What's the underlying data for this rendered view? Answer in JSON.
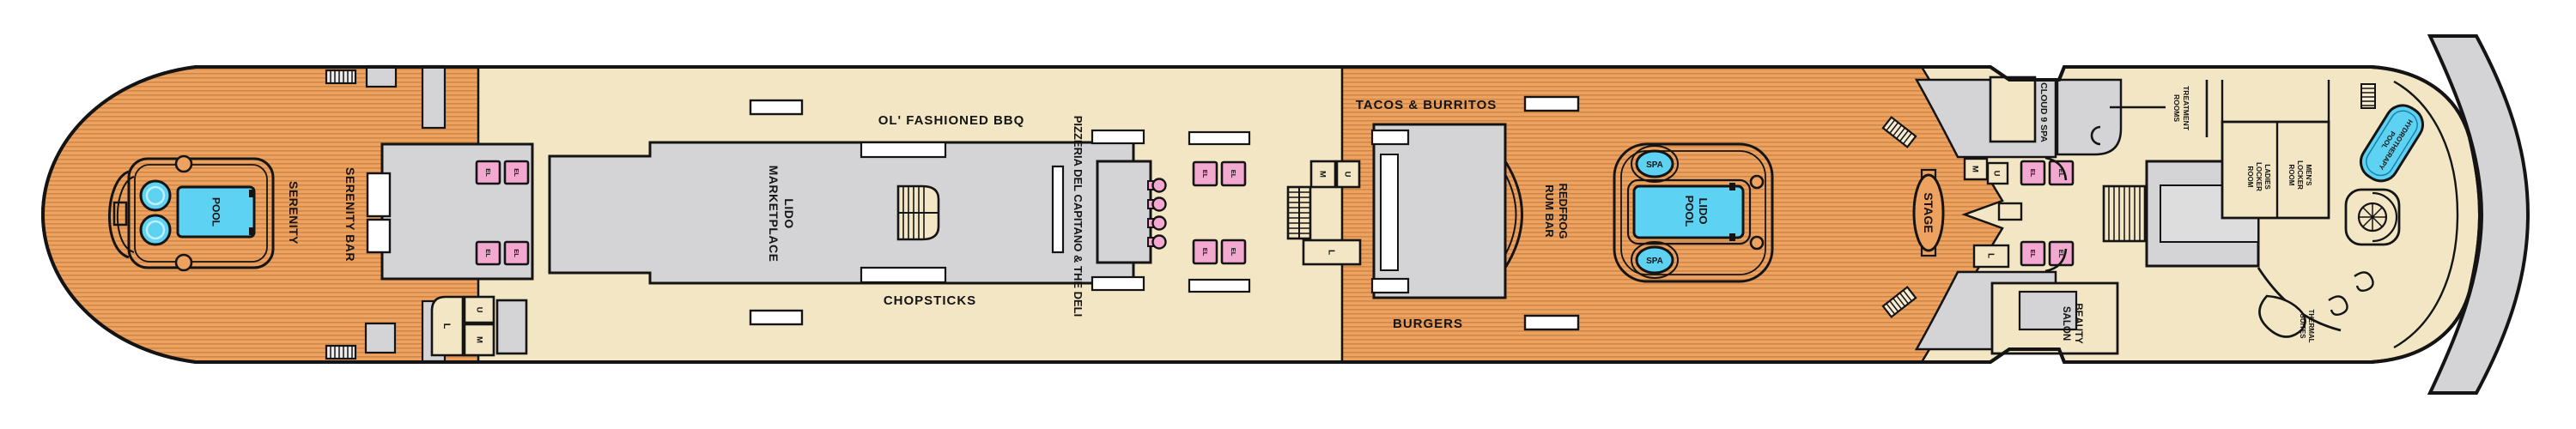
{
  "labels": {
    "serenity": "SERENITY",
    "serenity_bar": "SERENITY BAR",
    "pool": "POOL",
    "lido": "LIDO",
    "marketplace": "MARKETPLACE",
    "ol_fashioned_bbq": "OL' FASHIONED BBQ",
    "chopsticks": "CHOPSTICKS",
    "pizzeria_deli": "PIZZERIA DEL CAPITANO & THE DELI",
    "tacos_burritos": "TACOS & BURRITOS",
    "burgers": "BURGERS",
    "redfrog": "REDFROG",
    "rum_bar": "RUM BAR",
    "spa": "SPA",
    "stage": "STAGE",
    "cloud_9_spa": "CLOUD 9 SPA",
    "beauty": "BEAUTY",
    "salon": "SALON",
    "treatment": "TREATMENT",
    "rooms": "ROOMS",
    "ladies": "LADIES",
    "locker": "LOCKER",
    "room": "ROOM",
    "mens": "MEN'S",
    "hydrotherapy": "HYDROTHERAPY",
    "thermal": "THERMAL",
    "suites": "SUITES",
    "el": "EL",
    "u": "U",
    "m": "M",
    "l": "L"
  },
  "colors": {
    "wood": "#eda25f",
    "wood_stripe": "#cf8646",
    "interior_cream": "#f2e6c5",
    "structure_gray": "#d4d4d6",
    "water_blue": "#5ed2f2",
    "elevator_pink": "#f3a8cf",
    "outline": "#141414",
    "background": "#ffffff"
  }
}
